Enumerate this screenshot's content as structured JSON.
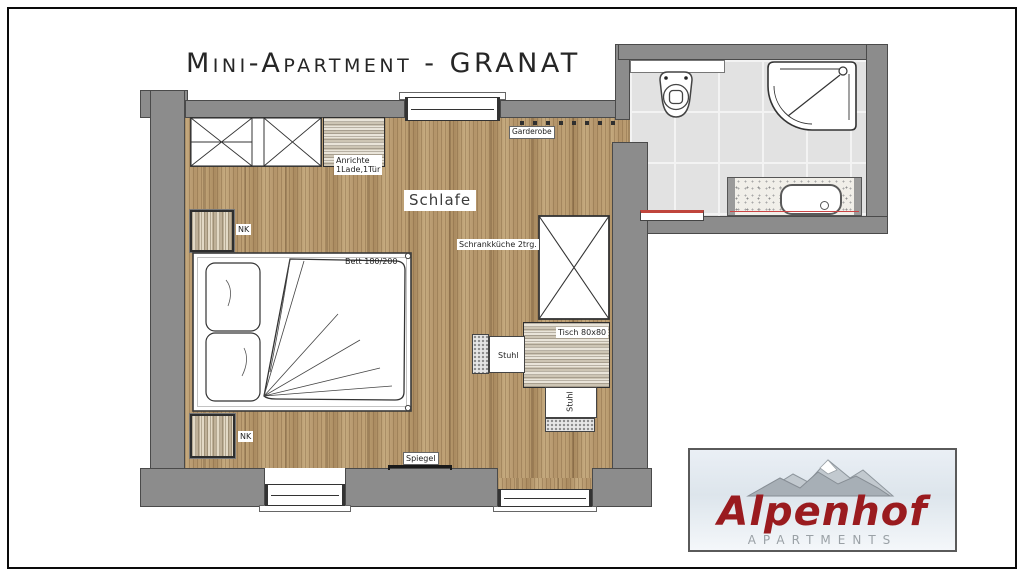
{
  "title": "Mini-Apartment - GRANAT",
  "room": {
    "name": "Schlafe"
  },
  "labels": {
    "garderobe": "Garderobe",
    "anrichte_line1": "Anrichte",
    "anrichte_line2": "1Lade,1Tür",
    "nk": "NK",
    "bett": "Bett 180/200",
    "schrankkueche": "Schrankküche 2trg.",
    "tisch": "Tisch 80x80",
    "stuhl": "Stuhl",
    "spiegel": "Spiegel"
  },
  "logo": {
    "name": "Alpenhof",
    "subtitle": "APARTMENTS",
    "name_color": "#9a1b1f",
    "subtitle_color": "#9aa1a6"
  },
  "colors": {
    "wall": "#8c8c8c",
    "wall_outline": "#4a4a4a",
    "wood_floor": "#b59871",
    "tile_floor": "#e2e2e2",
    "radiator_accent": "#c0453c",
    "vanity_accent": "#cc4444"
  }
}
